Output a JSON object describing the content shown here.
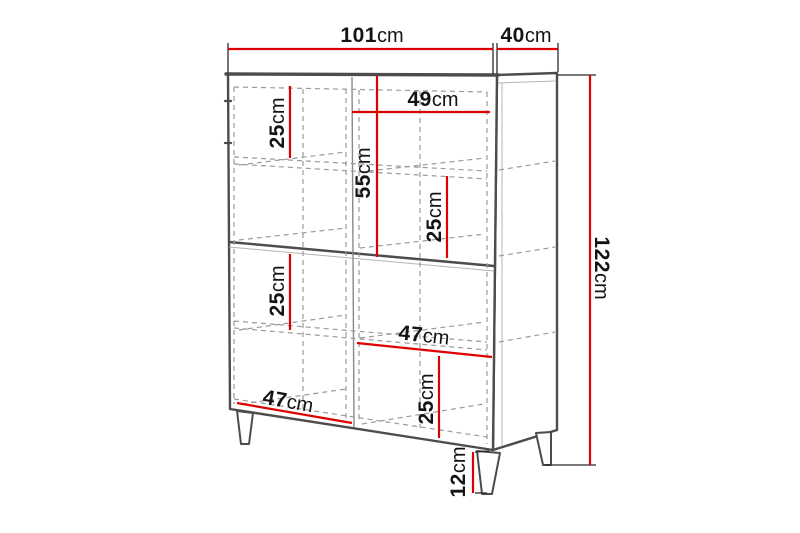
{
  "diagram": {
    "kind": "furniture-dimension-drawing",
    "subject": "highboard cabinet with legs, perspective line drawing with dimension callouts",
    "unit": "cm"
  },
  "colors": {
    "accent_red": "#de0000",
    "outline_gray": "#4c4c4c",
    "dashed_gray": "#9a9a9a",
    "text_black": "#141414",
    "background": "#ffffff"
  },
  "labels": {
    "top_width": {
      "value": "101",
      "unit": "cm"
    },
    "top_depth": {
      "value": "40",
      "unit": "cm"
    },
    "total_height": {
      "value": "122",
      "unit": "cm"
    },
    "upper_left_shelf_height": {
      "value": "25",
      "unit": "cm"
    },
    "right_door_width": {
      "value": "49",
      "unit": "cm"
    },
    "upper_section_height": {
      "value": "55",
      "unit": "cm"
    },
    "upper_right_shelf_height": {
      "value": "25",
      "unit": "cm"
    },
    "lower_left_shelf_height": {
      "value": "25",
      "unit": "cm"
    },
    "mid_right_width": {
      "value": "47",
      "unit": "cm"
    },
    "lower_right_shelf_height": {
      "value": "25",
      "unit": "cm"
    },
    "bottom_left_width": {
      "value": "47",
      "unit": "cm"
    },
    "leg_height": {
      "value": "12",
      "unit": "cm"
    }
  }
}
